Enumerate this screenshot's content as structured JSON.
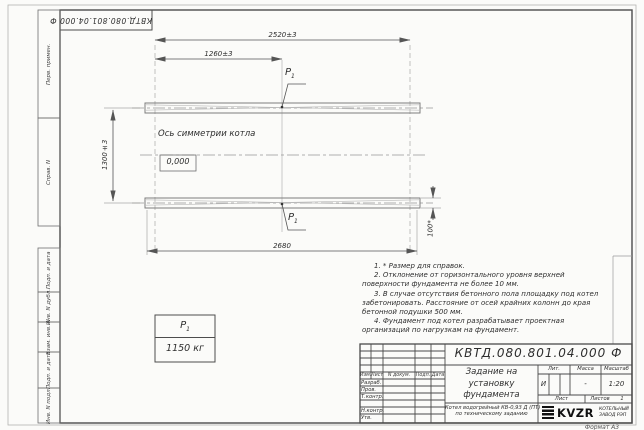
{
  "designation": "КВТД.080.801.04.000 Ф",
  "margin": {
    "fields": [
      "Перв. примен.",
      "Справ. N",
      "Подп. и дата",
      "Инв. N дубл.",
      "Взам. инв. N",
      "Подп. и дата",
      "Инв. N подл."
    ]
  },
  "drawing": {
    "dim_top": "2520±3",
    "dim_half": "1260±3",
    "dim_height": "1300±3",
    "dim_bottom": "2680",
    "dim_pad": "100*",
    "axis_label": "Ось симметрии котла",
    "elevation": "0,000",
    "load_symbol": "P",
    "load_index": "1"
  },
  "load_table": {
    "value": "1150 кг"
  },
  "notes": [
    "1. * Размер для справок.",
    "2. Отклонение от горизонтального уровня верхней поверхности фундамента не более 10 мм.",
    "3. В случае отсутствия бетонного пола площадку под котел забетонировать. Расстояние от осей крайних колонн до края бетонной подушки 500 мм.",
    "4. Фундамент под котел разрабатывает проектная организаций по нагрузкам на фундамент."
  ],
  "stamp": {
    "title": "Задание на установку фундамента",
    "product_line1": "Котел водогрейный КВ-0,93 Д (ПТ)",
    "product_line2": "по техническому заданию",
    "h_izm": "Изм.",
    "h_list": "Лист",
    "h_ndoc": "N докум.",
    "h_podp": "Подп.",
    "h_data": "Дата",
    "rows": [
      "Разраб.",
      "Пров.",
      "Т.контр.",
      "Н.контр.",
      "Утв."
    ],
    "h_lit": "Лит.",
    "h_mass": "Масса",
    "h_scale": "Масштаб",
    "v_lit": "И",
    "v_mass": "-",
    "v_scale": "1:20",
    "h_sheet": "Лист",
    "h_sheets": "Листов",
    "v_sheets": "1",
    "logo": "KVZR",
    "company_line1": "КОТЕЛЬНЫЙ",
    "company_line2": "ЗАВОД РЭП",
    "format": "Формат А3"
  }
}
